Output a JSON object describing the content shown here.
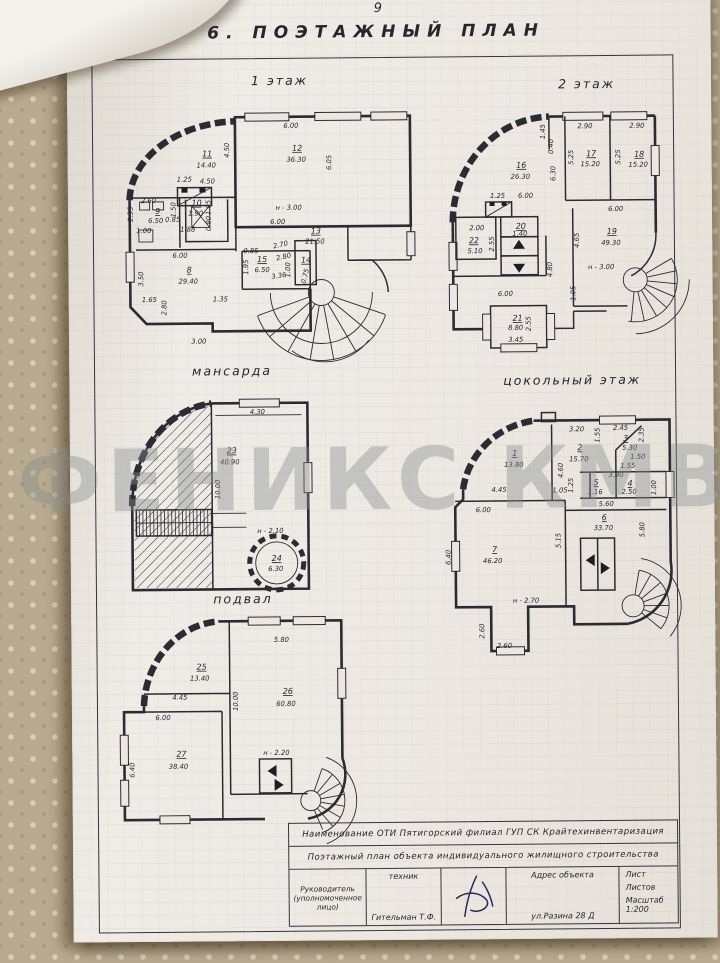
{
  "page": {
    "number": "9",
    "title": "6. ПОЭТАЖНЫЙ ПЛАН",
    "watermark": "ФЕНИКС КМВ"
  },
  "floors": [
    {
      "id": "f1",
      "label": "1 этаж",
      "labels": [
        {
          "t": "6.00",
          "x": 176,
          "y": 27
        },
        {
          "t": "12",
          "x": 182,
          "y": 50,
          "u": 1
        },
        {
          "t": "36.30",
          "x": 181,
          "y": 61
        },
        {
          "t": "6.05",
          "x": 216,
          "y": 62,
          "r": -90
        },
        {
          "t": "н - 3.00",
          "x": 173,
          "y": 109
        },
        {
          "t": "6.00",
          "x": 162,
          "y": 123
        },
        {
          "t": "11",
          "x": 92,
          "y": 55,
          "u": 1
        },
        {
          "t": "14.40",
          "x": 91,
          "y": 66
        },
        {
          "t": "4.50",
          "x": 114,
          "y": 49,
          "r": -90
        },
        {
          "t": "4.50",
          "x": 92,
          "y": 82
        },
        {
          "t": "1.25",
          "x": 69,
          "y": 80
        },
        {
          "t": "2.60",
          "x": 33,
          "y": 101
        },
        {
          "t": "9",
          "x": 42,
          "y": 112,
          "u": 1
        },
        {
          "t": "6.50",
          "x": 40,
          "y": 121
        },
        {
          "t": "2.35",
          "x": 17,
          "y": 112,
          "r": -90
        },
        {
          "t": "1.00",
          "x": 28,
          "y": 131
        },
        {
          "t": "0.85",
          "x": 57,
          "y": 120
        },
        {
          "t": "1.50",
          "x": 60,
          "y": 108,
          "r": -90
        },
        {
          "t": "1.88",
          "x": 72,
          "y": 130
        },
        {
          "t": "10",
          "x": 81,
          "y": 104,
          "u": 1
        },
        {
          "t": "1.90",
          "x": 80,
          "y": 114
        },
        {
          "t": "1.05",
          "x": 95,
          "y": 106,
          "r": -90
        },
        {
          "t": "0.80",
          "x": 95,
          "y": 122,
          "r": -90
        },
        {
          "t": "6.00",
          "x": 64,
          "y": 156
        },
        {
          "t": "8",
          "x": 73,
          "y": 171,
          "u": 1
        },
        {
          "t": "29.40",
          "x": 72,
          "y": 182
        },
        {
          "t": "3.50",
          "x": 27,
          "y": 177,
          "r": -90
        },
        {
          "t": "1.65",
          "x": 33,
          "y": 200
        },
        {
          "t": "1.35",
          "x": 104,
          "y": 200
        },
        {
          "t": "2.80",
          "x": 50,
          "y": 206,
          "r": -90
        },
        {
          "t": "3.00",
          "x": 82,
          "y": 242
        },
        {
          "t": "13",
          "x": 200,
          "y": 133,
          "u": 1
        },
        {
          "t": "21.50",
          "x": 199,
          "y": 143
        },
        {
          "t": "2.70",
          "x": 165,
          "y": 146,
          "r": -12
        },
        {
          "t": "2.80",
          "x": 168,
          "y": 158,
          "r": -12
        },
        {
          "t": "15",
          "x": 146,
          "y": 161,
          "u": 1
        },
        {
          "t": "6.50",
          "x": 146,
          "y": 171
        },
        {
          "t": "0.85",
          "x": 135,
          "y": 152
        },
        {
          "t": "1.95",
          "x": 132,
          "y": 166,
          "r": -90
        },
        {
          "t": "3.36",
          "x": 163,
          "y": 177,
          "r": -8
        },
        {
          "t": "1.00",
          "x": 174,
          "y": 169,
          "r": -90
        },
        {
          "t": "14",
          "x": 190,
          "y": 162,
          "u": 1
        },
        {
          "t": "0.75",
          "x": 191,
          "y": 176,
          "r": -75
        }
      ]
    },
    {
      "id": "f2",
      "label": "2 этаж",
      "labels": [
        {
          "t": "1.45",
          "x": 108,
          "y": 48,
          "r": -90
        },
        {
          "t": "0.40",
          "x": 116,
          "y": 63,
          "r": -90
        },
        {
          "t": "16",
          "x": 84,
          "y": 84,
          "u": 1
        },
        {
          "t": "26.30",
          "x": 83,
          "y": 95
        },
        {
          "t": "6.30",
          "x": 118,
          "y": 90,
          "r": -90
        },
        {
          "t": "2.90",
          "x": 148,
          "y": 45
        },
        {
          "t": "17",
          "x": 154,
          "y": 73,
          "u": 1
        },
        {
          "t": "15.20",
          "x": 153,
          "y": 83
        },
        {
          "t": "5.25",
          "x": 136,
          "y": 74,
          "r": -90
        },
        {
          "t": "2.90",
          "x": 200,
          "y": 45
        },
        {
          "t": "18",
          "x": 202,
          "y": 74,
          "u": 1
        },
        {
          "t": "15.20",
          "x": 201,
          "y": 84
        },
        {
          "t": "5.25",
          "x": 183,
          "y": 74,
          "r": -90
        },
        {
          "t": "6.00",
          "x": 88,
          "y": 114
        },
        {
          "t": "1.25",
          "x": 60,
          "y": 114
        },
        {
          "t": "6.00",
          "x": 178,
          "y": 128
        },
        {
          "t": "19",
          "x": 174,
          "y": 151,
          "u": 1
        },
        {
          "t": "49.30",
          "x": 173,
          "y": 162
        },
        {
          "t": "4.65",
          "x": 141,
          "y": 157,
          "r": -90
        },
        {
          "t": "н - 3.00",
          "x": 163,
          "y": 186
        },
        {
          "t": "4.80",
          "x": 114,
          "y": 186,
          "r": -90
        },
        {
          "t": "1.05",
          "x": 137,
          "y": 210,
          "r": -90
        },
        {
          "t": "2.00",
          "x": 39,
          "y": 146
        },
        {
          "t": "22",
          "x": 36,
          "y": 159,
          "u": 1
        },
        {
          "t": "5.10",
          "x": 37,
          "y": 169
        },
        {
          "t": "2.55",
          "x": 56,
          "y": 160,
          "r": -90
        },
        {
          "t": "20",
          "x": 83,
          "y": 145,
          "u": 1
        },
        {
          "t": "1.40",
          "x": 82,
          "y": 152
        },
        {
          "t": "6.00",
          "x": 67,
          "y": 212
        },
        {
          "t": "21",
          "x": 79,
          "y": 237,
          "u": 1
        },
        {
          "t": "8.80",
          "x": 77,
          "y": 246
        },
        {
          "t": "2.55",
          "x": 92,
          "y": 240,
          "r": -90
        },
        {
          "t": "3.45",
          "x": 77,
          "y": 258
        }
      ]
    },
    {
      "id": "mans",
      "label": "мансарда",
      "labels": [
        {
          "t": "4.30",
          "x": 146,
          "y": 21
        },
        {
          "t": "23",
          "x": 120,
          "y": 60,
          "u": 1
        },
        {
          "t": "40.90",
          "x": 118,
          "y": 71
        },
        {
          "t": "10.00",
          "x": 108,
          "y": 96,
          "r": -90
        },
        {
          "t": "н - 2.10",
          "x": 158,
          "y": 140
        },
        {
          "t": "24",
          "x": 164,
          "y": 168,
          "u": 1
        },
        {
          "t": "6.30",
          "x": 163,
          "y": 178
        }
      ]
    },
    {
      "id": "tsk",
      "label": "цокольный этаж",
      "labels": [
        {
          "t": "1",
          "x": 85,
          "y": 45,
          "u": 1
        },
        {
          "t": "13.80",
          "x": 84,
          "y": 56
        },
        {
          "t": "4.45",
          "x": 69,
          "y": 81
        },
        {
          "t": "2",
          "x": 150,
          "y": 40,
          "u": 1
        },
        {
          "t": "15.70",
          "x": 149,
          "y": 51
        },
        {
          "t": "3.20",
          "x": 147,
          "y": 21
        },
        {
          "t": "4.60",
          "x": 133,
          "y": 60,
          "r": -90
        },
        {
          "t": "1.55",
          "x": 170,
          "y": 25,
          "r": -90
        },
        {
          "t": "2.45",
          "x": 191,
          "y": 20
        },
        {
          "t": "3",
          "x": 196,
          "y": 31,
          "u": 1
        },
        {
          "t": "5.30",
          "x": 200,
          "y": 40
        },
        {
          "t": "2.35",
          "x": 214,
          "y": 25,
          "r": -90
        },
        {
          "t": "1.50",
          "x": 208,
          "y": 49
        },
        {
          "t": "1.55",
          "x": 198,
          "y": 58
        },
        {
          "t": "3.90",
          "x": 186,
          "y": 67
        },
        {
          "t": "4",
          "x": 200,
          "y": 76,
          "u": 1
        },
        {
          "t": "2.50",
          "x": 199,
          "y": 84
        },
        {
          "t": "1.00",
          "x": 226,
          "y": 78,
          "r": -90
        },
        {
          "t": "5",
          "x": 166,
          "y": 75,
          "u": 1
        },
        {
          "t": "1.16",
          "x": 165,
          "y": 84
        },
        {
          "t": "1.25",
          "x": 143,
          "y": 75,
          "r": -90
        },
        {
          "t": "1.05",
          "x": 130,
          "y": 82
        },
        {
          "t": "5.60",
          "x": 176,
          "y": 96
        },
        {
          "t": "6.00",
          "x": 53,
          "y": 101
        },
        {
          "t": "7",
          "x": 64,
          "y": 141,
          "u": 1
        },
        {
          "t": "46.20",
          "x": 62,
          "y": 152
        },
        {
          "t": "6.40",
          "x": 20,
          "y": 146,
          "r": -90
        },
        {
          "t": "н - 2.70",
          "x": 95,
          "y": 192
        },
        {
          "t": "2.60",
          "x": 53,
          "y": 220,
          "r": -90
        },
        {
          "t": "2.60",
          "x": 73,
          "y": 237
        },
        {
          "t": "6",
          "x": 174,
          "y": 110,
          "u": 1
        },
        {
          "t": "33.70",
          "x": 173,
          "y": 120
        },
        {
          "t": "5.15",
          "x": 130,
          "y": 130,
          "r": -90
        },
        {
          "t": "5.80",
          "x": 214,
          "y": 120,
          "r": -90
        }
      ]
    },
    {
      "id": "pdv",
      "label": "подвал",
      "labels": [
        {
          "t": "25",
          "x": 88,
          "y": 60,
          "u": 1
        },
        {
          "t": "13.40",
          "x": 86,
          "y": 71
        },
        {
          "t": "4.45",
          "x": 66,
          "y": 90
        },
        {
          "t": "5.80",
          "x": 168,
          "y": 33
        },
        {
          "t": "26",
          "x": 174,
          "y": 85,
          "u": 1
        },
        {
          "t": "60.80",
          "x": 172,
          "y": 97
        },
        {
          "t": "10.00",
          "x": 124,
          "y": 92,
          "r": -90
        },
        {
          "t": "6.00",
          "x": 49,
          "y": 110
        },
        {
          "t": "27",
          "x": 67,
          "y": 147,
          "u": 1
        },
        {
          "t": "38.40",
          "x": 64,
          "y": 159
        },
        {
          "t": "6.40",
          "x": 20,
          "y": 160,
          "r": -90
        },
        {
          "t": "н - 2.20",
          "x": 162,
          "y": 146
        }
      ]
    }
  ],
  "title_block": {
    "row1": "Наименование ОТИ  Пятигорский филиал ГУП СК Крайтехинвентаризация",
    "row2": "Поэтажный план объекта индивидуального жилищного строительства",
    "col1": "Руководитель (уполномоченное лицо)",
    "col2_top": "техник",
    "col2_bottom": "Гительман Т.Ф.",
    "col4_top": "Адрес объекта",
    "col4_bottom": "ул.Разина 28 Д",
    "col5_line1": "Лист",
    "col5_line2": "Листов",
    "col5_line3": "Масштаб 1:200"
  }
}
